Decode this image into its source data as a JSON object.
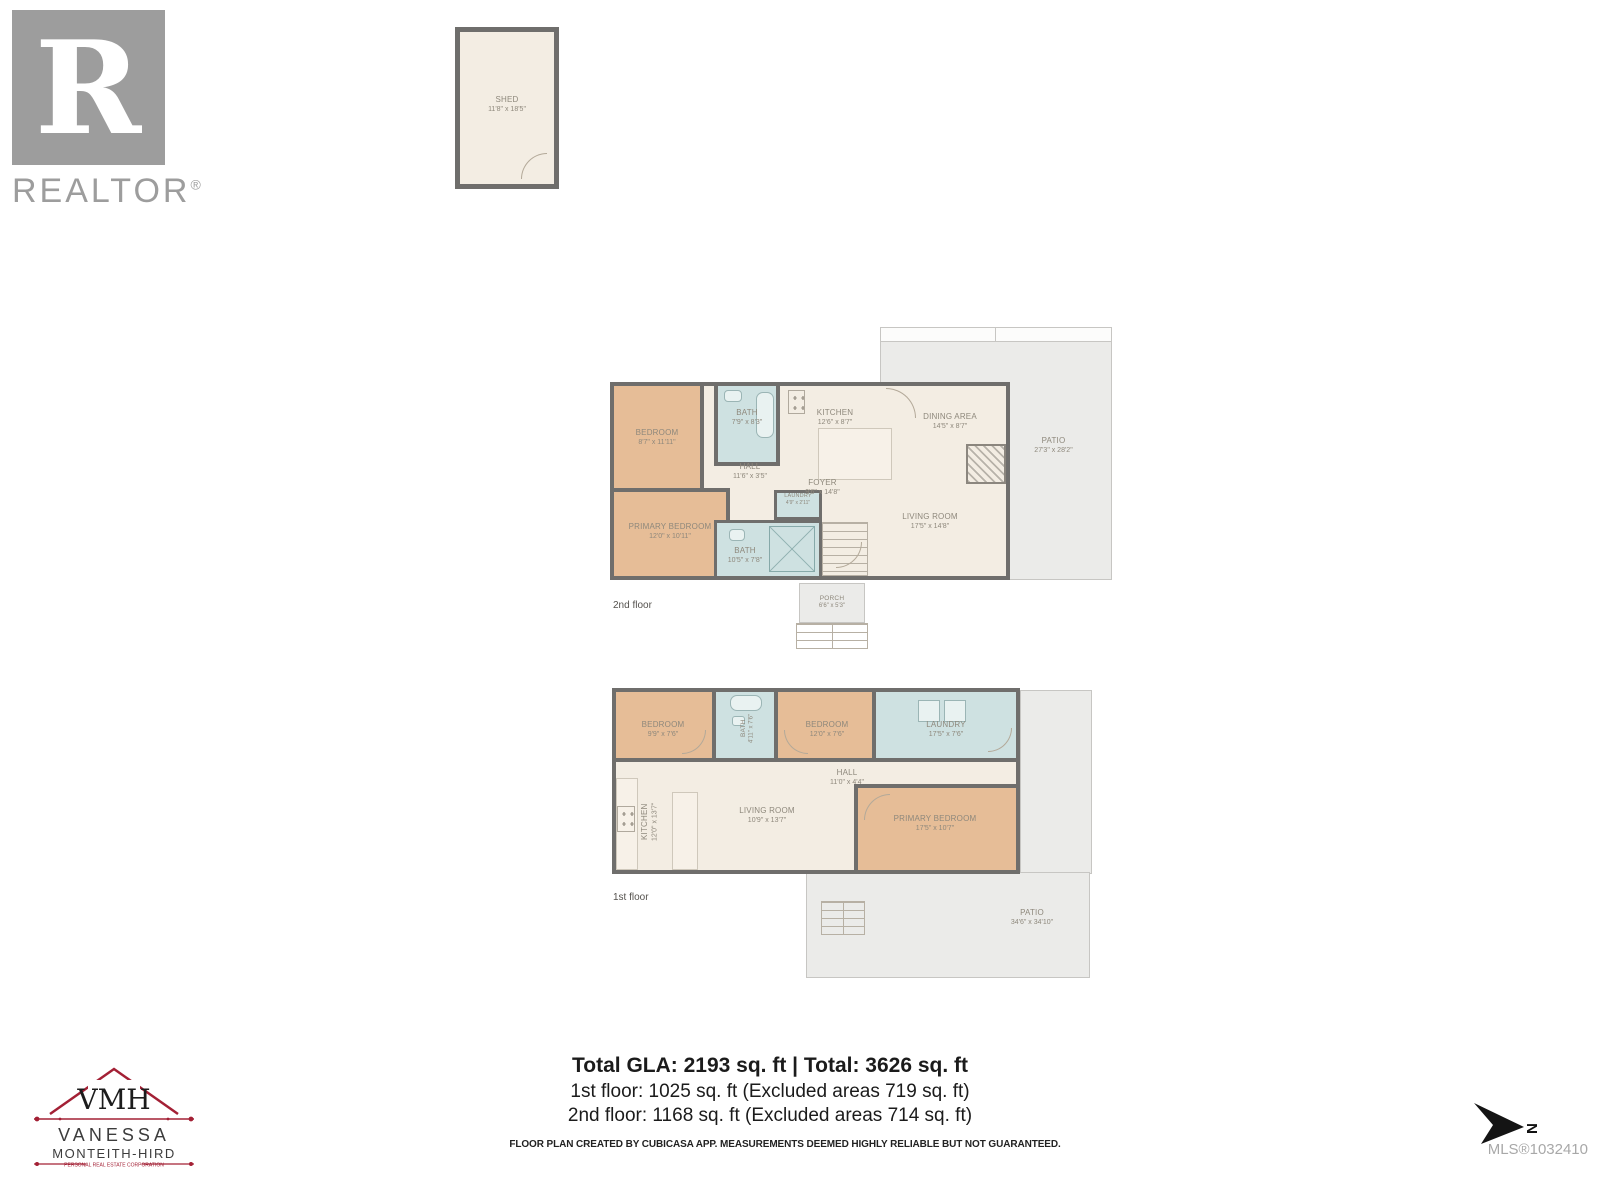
{
  "branding": {
    "realtor": {
      "letter": "R",
      "word": "REALTOR",
      "reg": "®"
    },
    "agent": {
      "monogram": "VMH",
      "name1": "VANESSA",
      "name2": "MONTEITH-HIRD",
      "tagline": "PERSONAL REAL ESTATE CORPORATION"
    }
  },
  "shed": {
    "name": "SHED",
    "dims": "11'8\" x 18'5\""
  },
  "second_floor": {
    "label": "2nd floor",
    "rooms": [
      {
        "name": "BEDROOM",
        "dims": "8'7\" x 11'11\""
      },
      {
        "name": "PRIMARY BEDROOM",
        "dims": "12'0\" x 10'11\""
      },
      {
        "name": "BATH",
        "dims": "7'9\" x 8'3\""
      },
      {
        "name": "BATH",
        "dims": "10'5\" x 7'8\""
      },
      {
        "name": "LAUNDRY",
        "dims": "4'9\" x 2'11\""
      },
      {
        "name": "HALL",
        "dims": "11'6\" x 3'5\""
      },
      {
        "name": "KITCHEN",
        "dims": "12'6\" x 8'7\""
      },
      {
        "name": "DINING AREA",
        "dims": "14'5\" x 8'7\""
      },
      {
        "name": "FOYER",
        "dims": "9'6\" x 14'8\""
      },
      {
        "name": "LIVING ROOM",
        "dims": "17'5\" x 14'8\""
      },
      {
        "name": "PATIO",
        "dims": "27'3\" x 28'2\""
      },
      {
        "name": "PORCH",
        "dims": "6'6\" x 5'3\""
      }
    ]
  },
  "first_floor": {
    "label": "1st floor",
    "rooms": [
      {
        "name": "BEDROOM",
        "dims": "9'9\" x 7'6\""
      },
      {
        "name": "BATH",
        "dims": "4'11\" x 7'6\""
      },
      {
        "name": "BEDROOM",
        "dims": "12'0\" x 7'6\""
      },
      {
        "name": "LAUNDRY",
        "dims": "17'5\" x 7'6\""
      },
      {
        "name": "KITCHEN",
        "dims": "12'0\" x 13'7\""
      },
      {
        "name": "LIVING ROOM",
        "dims": "10'9\" x 13'7\""
      },
      {
        "name": "HALL",
        "dims": "11'0\" x 4'4\""
      },
      {
        "name": "PRIMARY BEDROOM",
        "dims": "17'5\" x 10'7\""
      },
      {
        "name": "PATIO",
        "dims": "34'6\" x 34'10\""
      }
    ]
  },
  "summary": {
    "line1": "Total GLA: 2193 sq. ft | Total: 3626 sq. ft",
    "line2": "1st floor: 1025 sq. ft (Excluded areas 719 sq. ft)",
    "line3": "2nd floor: 1168 sq. ft (Excluded areas 714 sq. ft)"
  },
  "footer": {
    "disclaimer": "FLOOR PLAN CREATED BY CUBICASA APP. MEASUREMENTS DEEMED HIGHLY RELIABLE BUT NOT GUARANTEED.",
    "mls": "MLS®1032410"
  },
  "compass": {
    "label": "N"
  },
  "colors": {
    "wall": "#6f6e6c",
    "room_tan": "#e6bd97",
    "room_blue": "#cee1e1",
    "room_cream": "#f3ede3",
    "patio_gray": "#ebebe9",
    "accent_red": "#a32035",
    "logo_gray": "#9d9d9d"
  }
}
